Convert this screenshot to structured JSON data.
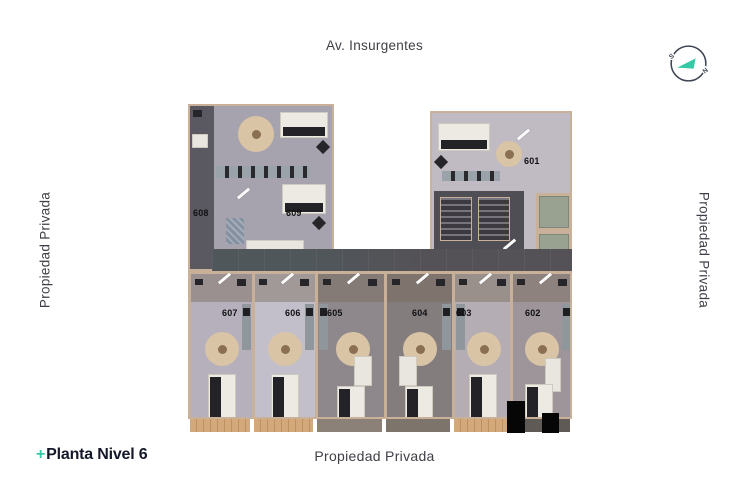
{
  "street_top": {
    "label": "Av. Insurgentes"
  },
  "property_left": {
    "label": "Propiedad Privada"
  },
  "property_right": {
    "label": "Propiedad Privada"
  },
  "property_bottom": {
    "label": "Propiedad Privada"
  },
  "logo": {
    "plus": "+",
    "title": "Planta Nivel 6"
  },
  "compass": {
    "south": "S",
    "north": "N"
  },
  "plan": {
    "name": "Floor plan level 6",
    "units": [
      {
        "label": "601"
      },
      {
        "label": "602"
      },
      {
        "label": "603"
      },
      {
        "label": "604"
      },
      {
        "label": "605"
      },
      {
        "label": "606"
      },
      {
        "label": "607"
      },
      {
        "label": "608"
      },
      {
        "label": "609"
      }
    ]
  },
  "colors": {
    "accent_teal": "#35c9a6",
    "ink": "#14182a",
    "label_gray": "#3f3f47",
    "wall_beige": "#c9b199",
    "corridor_gray": "#545257"
  }
}
